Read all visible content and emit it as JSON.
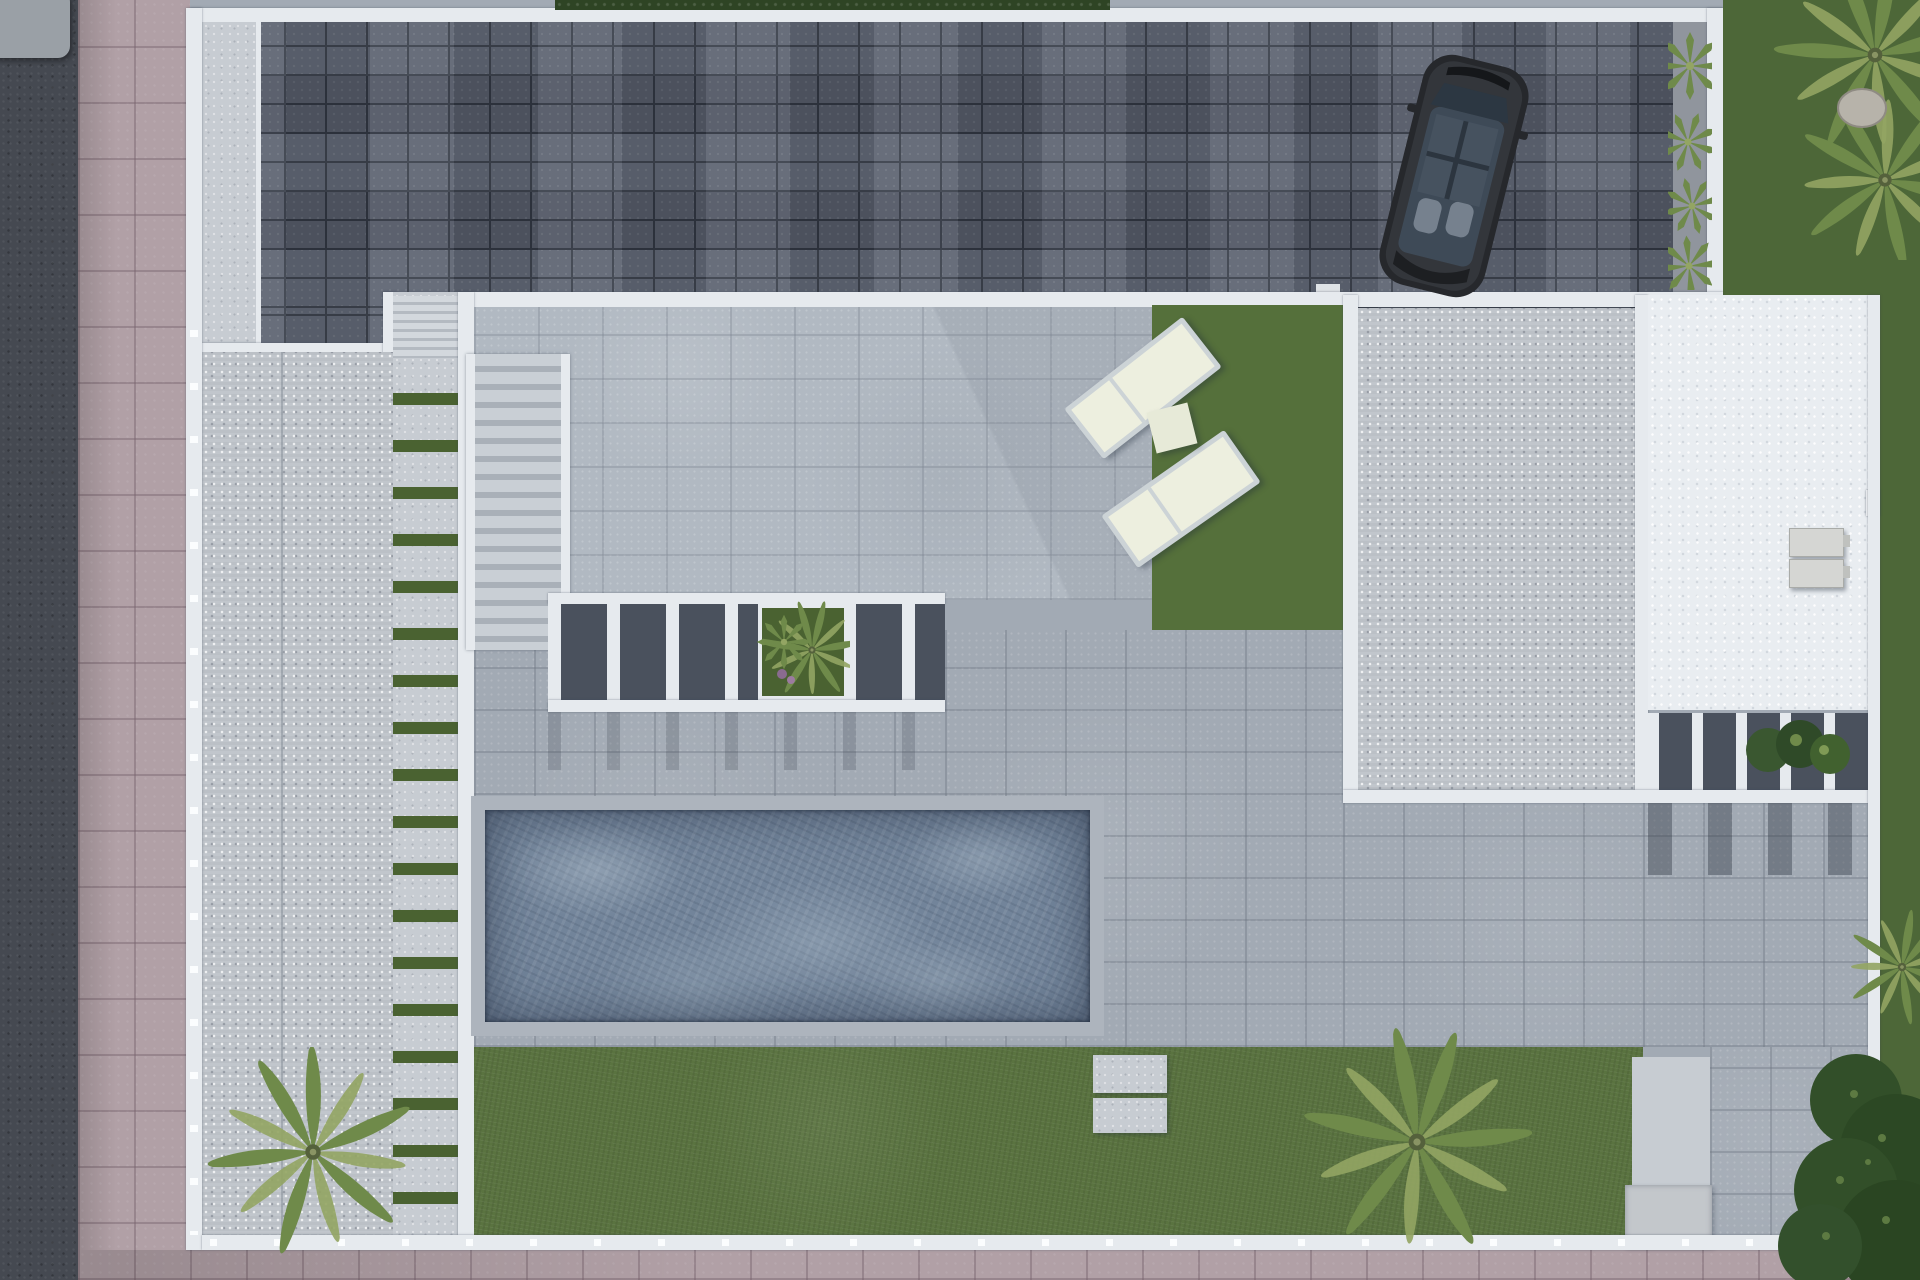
{
  "meta": {
    "description": "Top-down aerial 3D architectural rendering of a modern villa plot with driveway, parked car, roof terraces, pergolas, sun loungers, swimming pool, lawns and palm trees",
    "view": "top-down",
    "visible_text": "none"
  },
  "colors": {
    "street": "#454951",
    "sidewalk": "#b1a0a6",
    "paver": "#59606e",
    "paver_joint": "#343a46",
    "wall": "#e6eaee",
    "concrete": "#c7ccd2",
    "speckle": "#c1c6cc",
    "roof_white": "#e9edf1",
    "tile_upper": "#b1b9c2",
    "tile_mid": "#a2aab4",
    "grass": "#5a7340",
    "grass_patch": "#55703b",
    "grass_right": "#4d6738",
    "grass_strip": "#4a6231",
    "hedge": "#2e4424",
    "gravel": "#90959d",
    "water": "#72849a",
    "coping": "#adb4bd",
    "lounger_frame": "#ccd3d6",
    "cushion": "#edefdf",
    "table": "#e7ead8",
    "car_body": "#26282c",
    "car_glass": "#3e4a57",
    "car_seat": "#76818e",
    "plant": "#6f8a4a",
    "plant_light": "#93a563",
    "bush": "#324f29",
    "ac": "#d5d6d3",
    "step_dark": "#4a515d"
  },
  "inventory": {
    "swimming_pool": 1,
    "sun_loungers": 2,
    "side_table": 1,
    "car": 1,
    "palm_trees_large": 2,
    "corner_plant_clusters": 2,
    "gravel_bed_plants": 4,
    "ac_units": 2,
    "staircases": 2,
    "pergola_bands": 2,
    "stepping_stones": 2,
    "garden_rock": 1
  }
}
